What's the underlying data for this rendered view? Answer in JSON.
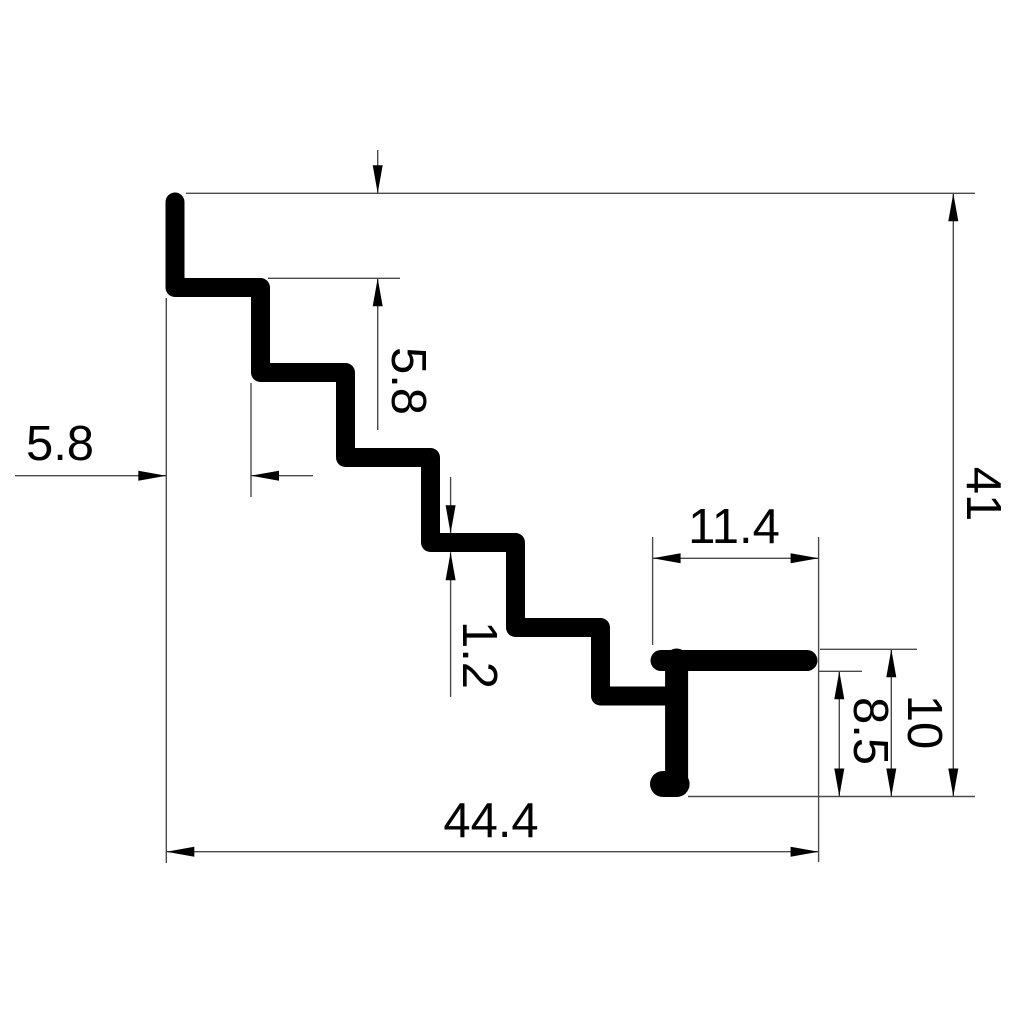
{
  "drawing": {
    "kind": "dimensioned technical drawing of a stair-step extrusion profile",
    "background_color": "#ffffff",
    "profile_color": "#000000",
    "dimension_line_color": "#4a4a4a",
    "text_color": "#000000",
    "dimensions": {
      "step_depth": {
        "label": "5.8",
        "orientation": "horizontal"
      },
      "step_height": {
        "label": "5.8",
        "orientation": "vertical"
      },
      "wall_thickness": {
        "label": "1.2",
        "orientation": "vertical"
      },
      "flange_width": {
        "label": "11.4",
        "orientation": "horizontal"
      },
      "total_height": {
        "label": "41",
        "orientation": "vertical"
      },
      "leg_height_overall": {
        "label": "10",
        "orientation": "vertical"
      },
      "leg_height_inner": {
        "label": "8.5",
        "orientation": "vertical"
      },
      "total_width": {
        "label": "44.4",
        "orientation": "horizontal"
      }
    }
  }
}
